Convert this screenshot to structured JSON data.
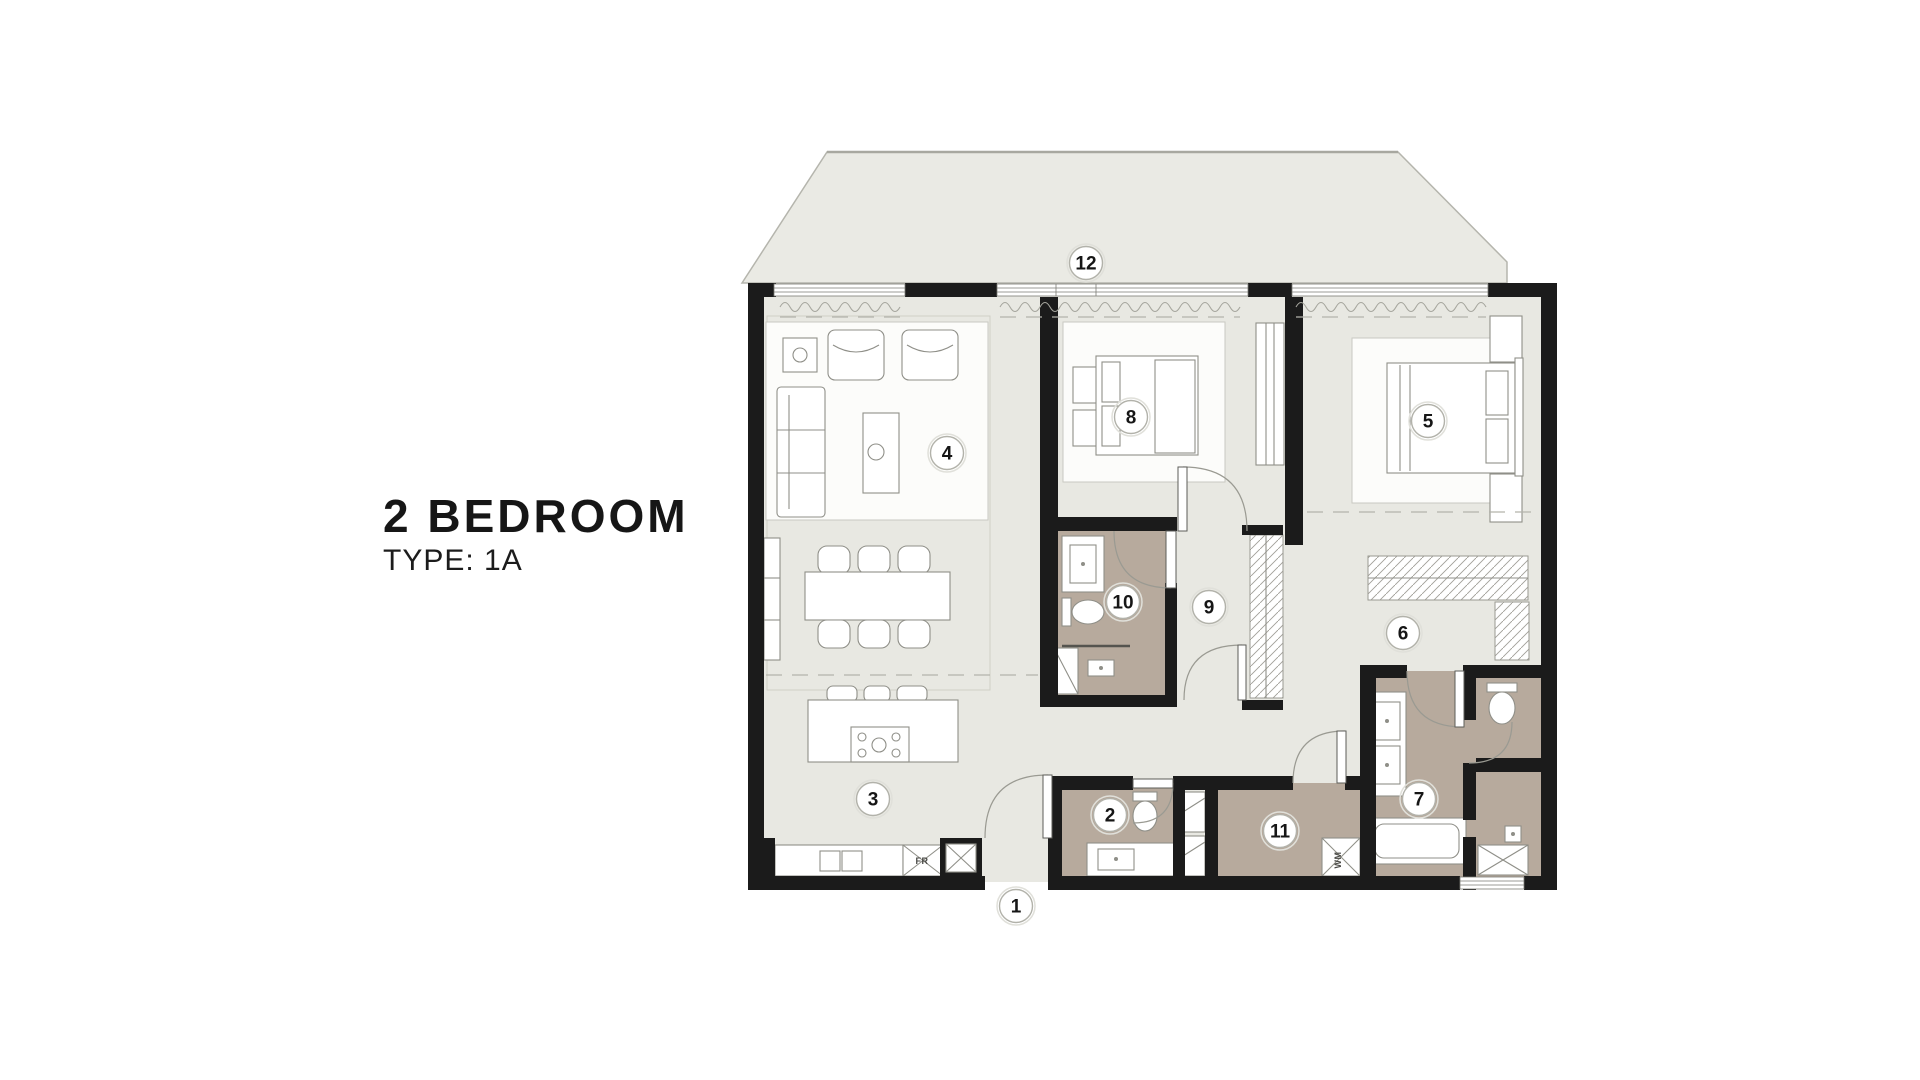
{
  "title": {
    "heading": "2 BEDROOM",
    "subheading": "TYPE: 1A"
  },
  "plan": {
    "colors": {
      "wall": "#1b1b1b",
      "floor": "#e8e8e2",
      "balcony": "#eaeae4",
      "wet_area": "#b7aa9d",
      "furniture_line": "#8f8f88"
    },
    "markers": [
      {
        "number": "1",
        "x": 1016,
        "y": 906
      },
      {
        "number": "2",
        "x": 1110,
        "y": 815
      },
      {
        "number": "3",
        "x": 873,
        "y": 799
      },
      {
        "number": "4",
        "x": 947,
        "y": 453
      },
      {
        "number": "5",
        "x": 1428,
        "y": 421
      },
      {
        "number": "6",
        "x": 1403,
        "y": 633
      },
      {
        "number": "7",
        "x": 1419,
        "y": 799
      },
      {
        "number": "8",
        "x": 1131,
        "y": 417
      },
      {
        "number": "9",
        "x": 1209,
        "y": 607
      },
      {
        "number": "10",
        "x": 1123,
        "y": 602
      },
      {
        "number": "11",
        "x": 1280,
        "y": 831
      },
      {
        "number": "12",
        "x": 1086,
        "y": 263
      }
    ],
    "appliance_labels": [
      {
        "text": "FR",
        "x": 922,
        "y": 864,
        "rotate": 0
      },
      {
        "text": "WM",
        "x": 1341,
        "y": 860,
        "rotate": -90
      }
    ]
  }
}
